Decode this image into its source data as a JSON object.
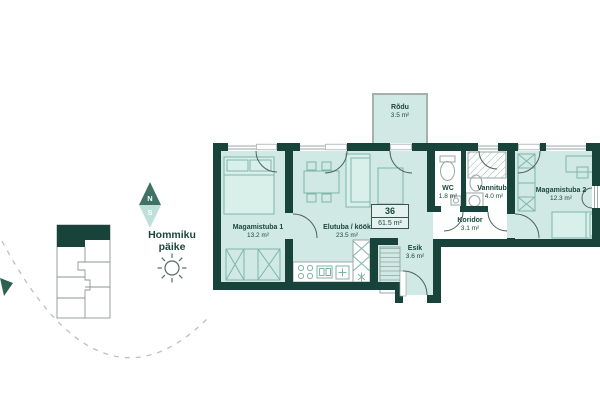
{
  "floor_plan": {
    "unit": {
      "number": "36",
      "total_area": "61.5 m²"
    },
    "rooms": {
      "rodu": {
        "name": "Rõdu",
        "area": "3.5 m²"
      },
      "magamistuba1": {
        "name": "Magamistuba 1",
        "area": "13.2 m²"
      },
      "elutuba": {
        "name": "Elutuba / köök",
        "area": "23.5 m²"
      },
      "wc": {
        "name": "WC",
        "area": "1.8 m²"
      },
      "vannituba": {
        "name": "Vannituba",
        "area": "4.0 m²"
      },
      "koridor": {
        "name": "Koridor",
        "area": "3.1 m²"
      },
      "esik": {
        "name": "Esik",
        "area": "3.6 m²"
      },
      "magamistuba2": {
        "name": "Magamistuba 2",
        "area": "12.3 m²"
      }
    }
  },
  "orientation": {
    "compass": {
      "north": "N",
      "south": "S"
    },
    "sun_label": {
      "line1": "Hommiku",
      "line2": "päike"
    }
  },
  "colors": {
    "wall": "#17433a",
    "floor": "#d0e9e4",
    "wet_room_floor": "#ffffff",
    "compass_north": "#3f7264",
    "compass_south": "#bfe0d8",
    "text": "#1b463b"
  }
}
